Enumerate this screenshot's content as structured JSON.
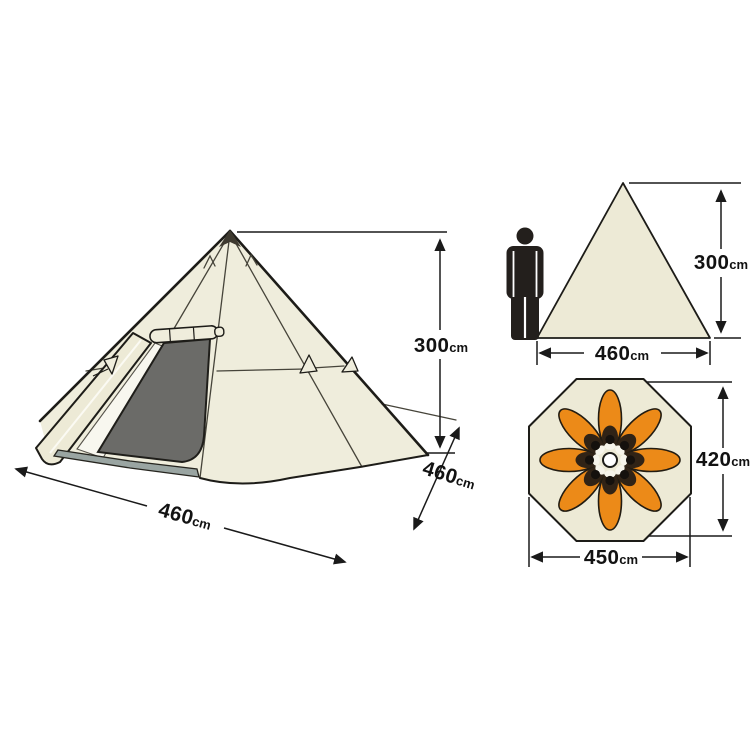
{
  "diagram": {
    "unit": "cm",
    "main_view": {
      "height": {
        "value": "300",
        "unit": "cm"
      },
      "width": {
        "value": "460",
        "unit": "cm"
      },
      "depth": {
        "value": "460",
        "unit": "cm"
      }
    },
    "side_view": {
      "height": {
        "value": "300",
        "unit": "cm"
      },
      "width": {
        "value": "460",
        "unit": "cm"
      }
    },
    "floor_plan": {
      "height": {
        "value": "420",
        "unit": "cm"
      },
      "width": {
        "value": "450",
        "unit": "cm"
      },
      "sleeping_bags": 8
    },
    "colors": {
      "canvas": "#ffffff",
      "tent_fabric": "#efeddc",
      "outline": "#1d1c18",
      "door_mesh": "#6b6b68",
      "groundsheet": "#9aa5a2",
      "sleeping_bag": "#ec8a18",
      "sleeping_bag_hood": "#302316",
      "person_figure": "#231f1c",
      "dimension_lines": "#1a1a1a"
    }
  }
}
